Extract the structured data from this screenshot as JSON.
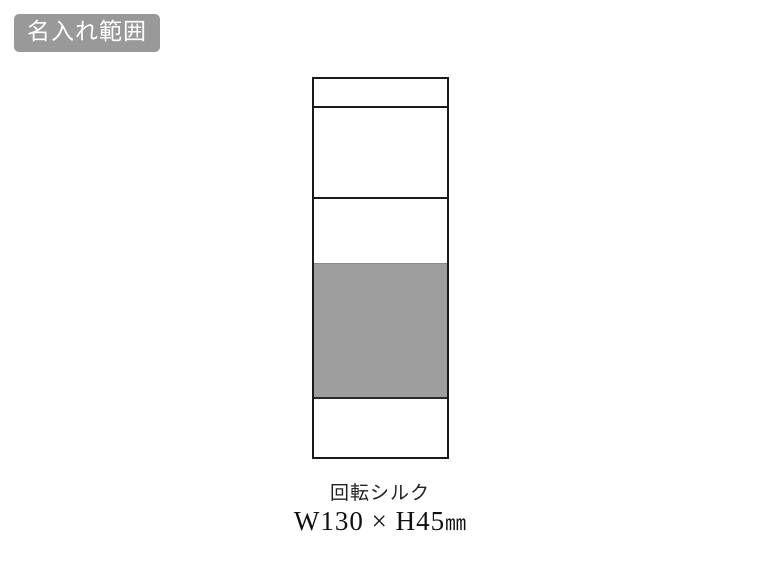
{
  "badge": {
    "label": "名入れ範囲"
  },
  "caption": {
    "method": "回転シルク",
    "dimensions": "W130 × H45",
    "unit": "㎜"
  },
  "colors": {
    "badge_bg": "#999999",
    "badge_text": "#ffffff",
    "print_area_fill": "#9e9e9e",
    "outline": "#1a1a1a"
  }
}
